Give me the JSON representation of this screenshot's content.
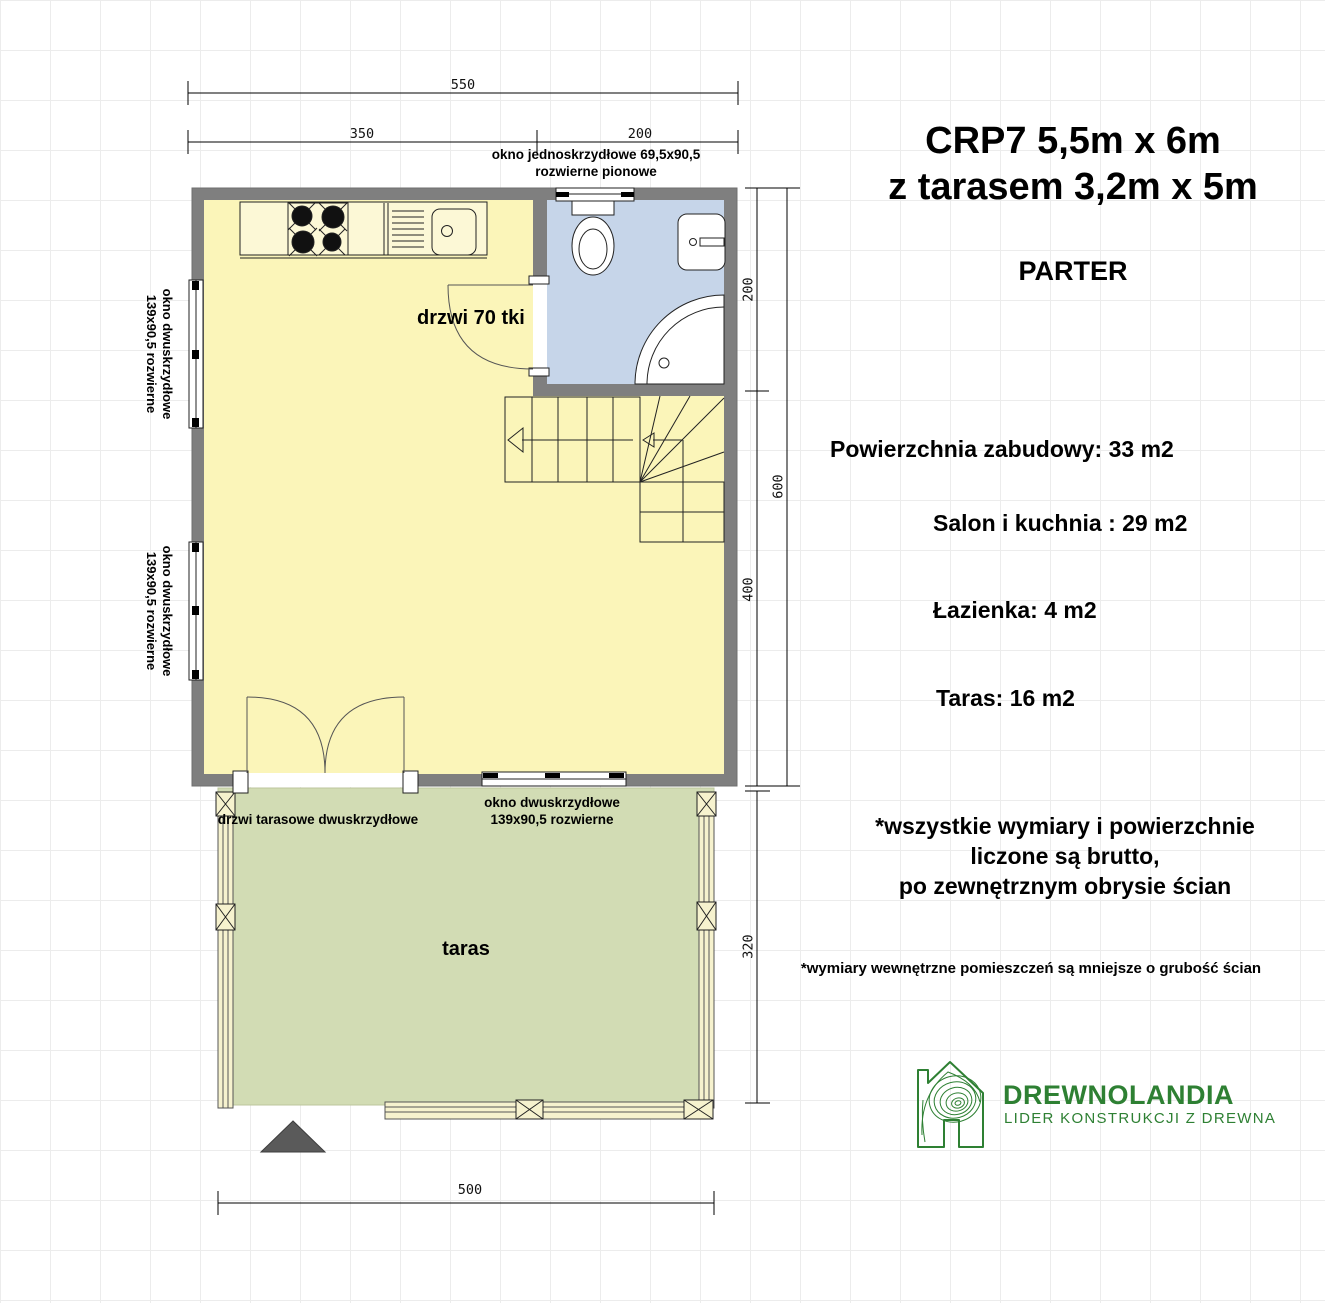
{
  "header": {
    "title_line1": "CRP7 5,5m x 6m",
    "title_line2": "z tarasem 3,2m x 5m",
    "floor_label": "PARTER"
  },
  "areas": {
    "built_up": "Powierzchnia zabudowy: 33 m2",
    "living_kitchen": "Salon i kuchnia : 29 m2",
    "bathroom": "Łazienka: 4 m2",
    "terrace": "Taras: 16 m2"
  },
  "notes": {
    "gross": {
      "line1": "*wszystkie wymiary i powierzchnie",
      "line2": "liczone są brutto,",
      "line3": "po zewnętrznym obrysie ścian"
    },
    "internal": "*wymiary wewnętrzne pomieszczeń są mniejsze o grubość ścian"
  },
  "logo": {
    "name": "DREWNOLANDIA",
    "tagline": "LIDER KONSTRUKCJI Z DREWNA"
  },
  "plan_labels": {
    "window_top": {
      "line1": "okno jednoskrzydłowe 69,5x90,5",
      "line2": "rozwierne pionowe"
    },
    "bathroom_door": "drzwi 70 tki",
    "window_left": {
      "line1": "okno dwuskrzydłowe",
      "line2": "139x90,5 rozwierne"
    },
    "terrace_door": "drzwi tarasowe dwuskrzydłowe",
    "window_bottom": {
      "line1": "okno dwuskrzydłowe",
      "line2": "139x90,5 rozwierne"
    },
    "terrace_room": "taras"
  },
  "dimensions": {
    "top_total": "550",
    "top_left": "350",
    "top_right": "200",
    "right_upper": "200",
    "right_lower": "400",
    "right_total": "600",
    "terrace_side": "320",
    "bottom_total": "500"
  },
  "colors": {
    "wall": "#7F7F7F",
    "room_fill": "#FBF5B9",
    "bathroom_fill": "#C6D5E9",
    "terrace_fill": "#D2DCB4",
    "railing_fill": "#F6F2CE",
    "logo_green": "#2E8033",
    "entrance_marker": "#5A5A5A"
  }
}
